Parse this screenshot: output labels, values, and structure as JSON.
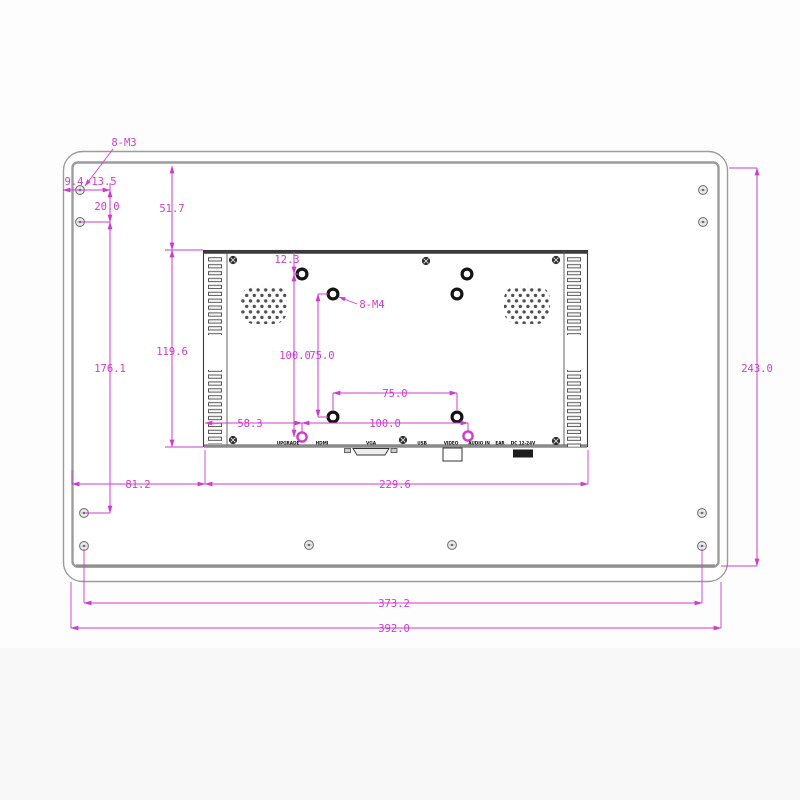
{
  "drawing": {
    "kind": "technical dimension drawing",
    "subject": "monitor rear panel with VESA mount",
    "units": "mm"
  },
  "colors": {
    "dimension": "#cf3dcf",
    "panel_outline": "#9c9c9c",
    "chassis_line": "#3a3a3a",
    "background": "#fdfdfd"
  },
  "callouts": {
    "outer_screws": "8-M3",
    "vesa_screws": "8-M4"
  },
  "dims": {
    "edge_offset": "9.4",
    "screw_inset": "13.5",
    "screw_gap_v": "20.0",
    "top_to_chassis": "51.7",
    "screw_span_v": "176.1",
    "chassis_height": "119.6",
    "top_to_hole": "12.3",
    "vesa100_v": "100.0",
    "vesa75_v": "75.0",
    "vesa75_h": "75.0",
    "vesa100_h": "100.0",
    "edge_to_hole": "58.3",
    "left_to_chassis": "81.2",
    "chassis_width": "229.6",
    "panel_height": "243.0",
    "screw_span_h": "373.2",
    "panel_width": "392.0"
  },
  "ports": [
    "UPGRADE",
    "HDMI",
    "VGA",
    "USB",
    "VIDEO",
    "AUDIO IN",
    "EAR",
    "DC 12-24V"
  ]
}
